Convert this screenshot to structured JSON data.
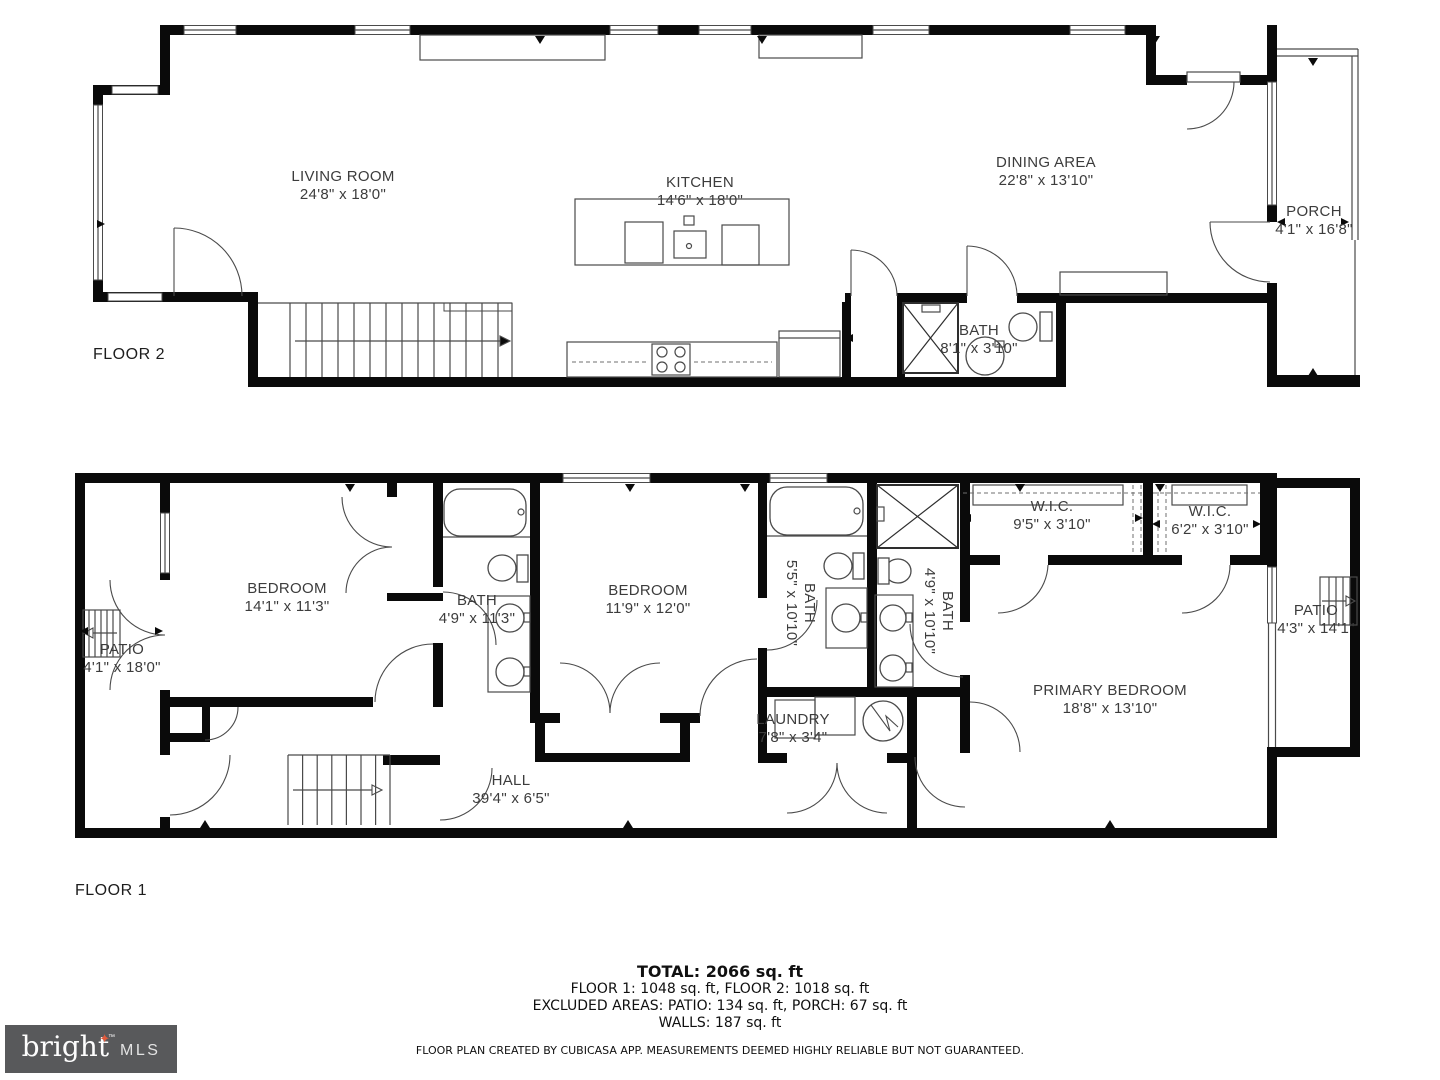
{
  "colors": {
    "wall": "#0a0a0a",
    "thin_line": "#4a4a4a",
    "text": "#3c3c3c",
    "logo_bg": "#58595b",
    "logo_star": "#e05a3c"
  },
  "floor2": {
    "label": "FLOOR 2",
    "rooms": [
      {
        "name": "LIVING ROOM",
        "dims": "24'8\" x 18'0\""
      },
      {
        "name": "KITCHEN",
        "dims": "14'6\" x 18'0\""
      },
      {
        "name": "DINING AREA",
        "dims": "22'8\" x 13'10\""
      },
      {
        "name": "PORCH",
        "dims": "4'1\" x 16'8\""
      },
      {
        "name": "BATH",
        "dims": "8'1\" x 3'10\""
      }
    ]
  },
  "floor1": {
    "label": "FLOOR 1",
    "rooms": [
      {
        "name": "PATIO",
        "dims": "4'1\" x 18'0\""
      },
      {
        "name": "BEDROOM",
        "dims": "14'1\" x 11'3\""
      },
      {
        "name": "BATH",
        "dims": "4'9\" x 11'3\""
      },
      {
        "name": "BEDROOM",
        "dims": "11'9\" x 12'0\""
      },
      {
        "name": "BATH",
        "dims": "5'5\" x 10'10\""
      },
      {
        "name": "BATH",
        "dims": "4'9\" x 10'10\""
      },
      {
        "name": "W.I.C.",
        "dims": "9'5\" x 3'10\""
      },
      {
        "name": "W.I.C.",
        "dims": "6'2\" x 3'10\""
      },
      {
        "name": "PRIMARY BEDROOM",
        "dims": "18'8\" x 13'10\""
      },
      {
        "name": "PATIO",
        "dims": "4'3\" x 14'1\""
      },
      {
        "name": "LAUNDRY",
        "dims": "7'8\" x 3'4\""
      },
      {
        "name": "HALL",
        "dims": "39'4\" x 6'5\""
      }
    ]
  },
  "summary": {
    "total": "TOTAL: 2066 sq. ft",
    "floors": "FLOOR 1: 1048 sq. ft, FLOOR 2: 1018 sq. ft",
    "excluded": "EXCLUDED AREAS: PATIO: 134 sq. ft, PORCH: 67 sq. ft",
    "walls": "WALLS: 187 sq. ft"
  },
  "footer": "FLOOR PLAN CREATED BY CUBICASA APP. MEASUREMENTS DEEMED HIGHLY RELIABLE BUT NOT GUARANTEED.",
  "logo": {
    "brand": "bright",
    "tm": "™",
    "suffix": "MLS"
  }
}
